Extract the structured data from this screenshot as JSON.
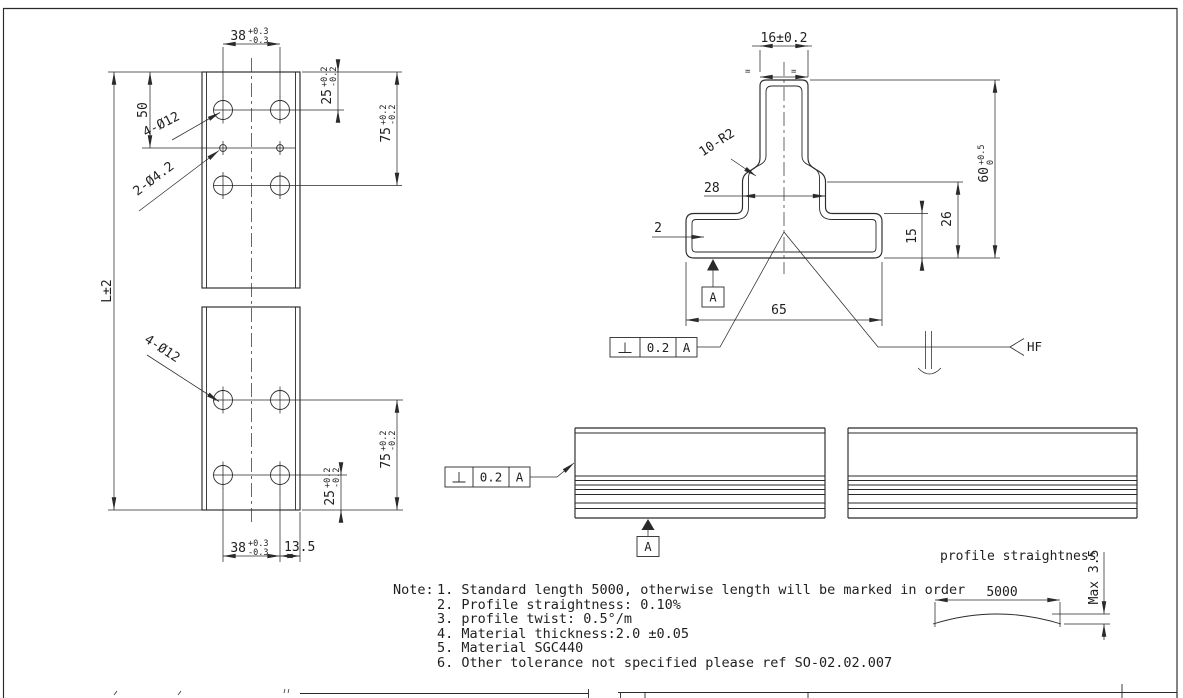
{
  "colors": {
    "line": "#2a2a2a",
    "background": "#ffffff"
  },
  "front_view": {
    "dim_width_top": {
      "v": "38",
      "up": "+0.3",
      "dn": "-0.3"
    },
    "dim_50": "50",
    "dim_length": "L±2",
    "leader_big_holes_top": "4-Ø12",
    "leader_small_holes": "2-Ø4.2",
    "dim_25_top": {
      "v": "25",
      "up": "+0.2",
      "dn": "-0.2"
    },
    "dim_75_top": {
      "v": "75",
      "up": "+0.2",
      "dn": "-0.2"
    },
    "leader_big_holes_bottom": "4-Ø12",
    "dim_75_bottom": {
      "v": "75",
      "up": "+0.2",
      "dn": "-0.2"
    },
    "dim_25_bottom": {
      "v": "25",
      "up": "+0.2",
      "dn": "-0.2"
    },
    "dim_width_bottom": {
      "v": "38",
      "up": "+0.3",
      "dn": "-0.3"
    },
    "dim_edge_offset": "13.5"
  },
  "section_view": {
    "dim_stem_width": "16±0.2",
    "equal_spacing": "=",
    "leader_radii": "10-R2",
    "dim_shoulder_width": "28",
    "dim_wall_thickness": "2",
    "dim_base_width": "65",
    "dim_base_height": "15",
    "dim_shoulder_height": "26",
    "dim_total_height": {
      "v": "60",
      "up": "+0.5",
      "dn": "0"
    },
    "datum_label": "A",
    "weld_process": "HF",
    "fcf": {
      "symbol": "⊥",
      "tolerance": "0.2",
      "datum": "A"
    }
  },
  "side_view": {
    "fcf": {
      "symbol": "⊥",
      "tolerance": "0.2",
      "datum": "A"
    },
    "datum_label": "A"
  },
  "straightness_detail": {
    "title": "profile straightness",
    "dim_length": "5000",
    "dim_max": "Max 3.5"
  },
  "notes": {
    "label": "Note:",
    "items": [
      "1. Standard length 5000, otherwise length will be marked in order",
      "2. Profile straightness: 0.10%",
      "3. profile twist: 0.5°/m",
      "4. Material thickness:2.0 ±0.05",
      "5. Material SGC440",
      "6. Other tolerance not specified please ref SO-02.02.007"
    ]
  }
}
